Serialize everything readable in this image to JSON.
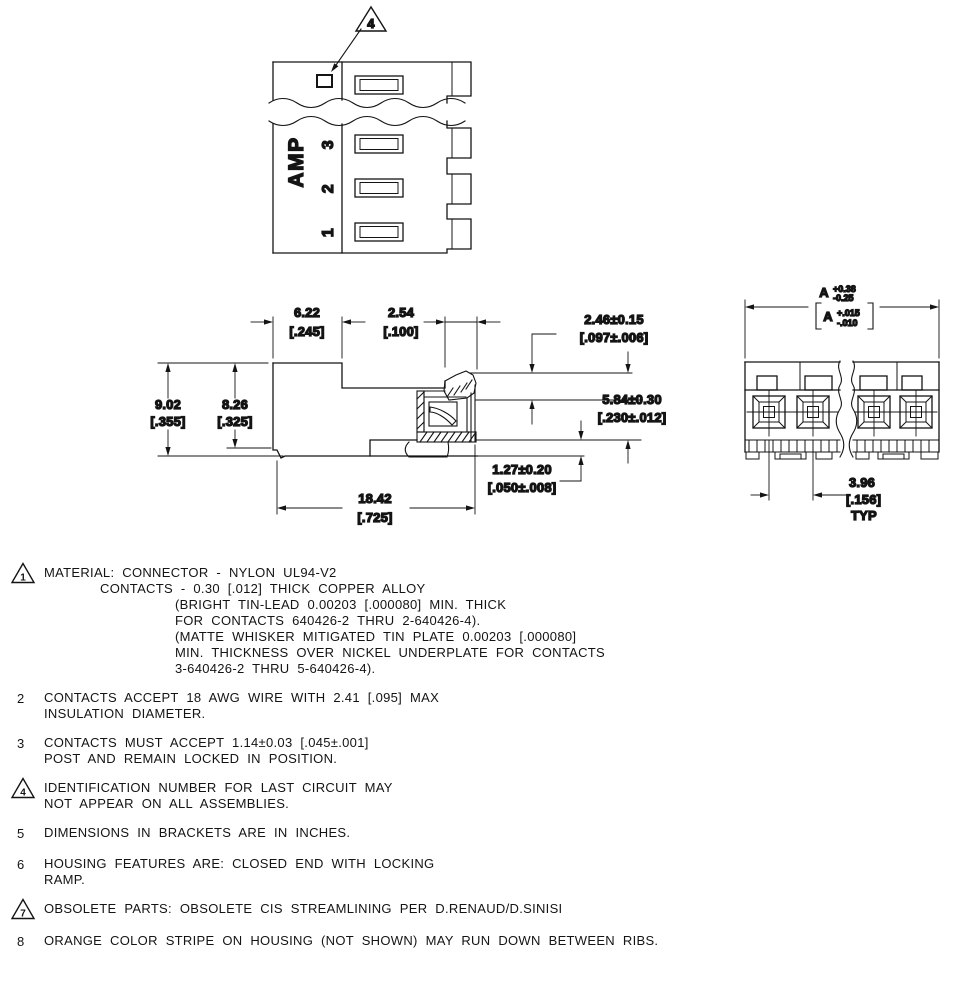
{
  "top_view": {
    "brand": "AMP",
    "circuit_3": "3",
    "circuit_2": "2",
    "circuit_1": "1",
    "callout_flag": "4"
  },
  "side_view": {
    "dim_step_mm": "6.22",
    "dim_step_in": "[.245]",
    "dim_pitch_mm": "2.54",
    "dim_pitch_in": "[.100]",
    "dim_contact_mm": "2.46±0.15",
    "dim_contact_in": "[.097±.006]",
    "dim_height_outer_mm": "9.02",
    "dim_height_outer_in": "[.355]",
    "dim_height_inner_mm": "8.26",
    "dim_height_inner_in": "[.325]",
    "dim_face_mm": "5.84±0.30",
    "dim_face_in": "[.230±.012]",
    "dim_standoff_mm": "1.27±0.20",
    "dim_standoff_in": "[.050±.008]",
    "dim_length_mm": "18.42",
    "dim_length_in": "[.725]"
  },
  "end_view": {
    "dim_a_letter": "A",
    "dim_a_plus": "+0.38",
    "dim_a_minus": "-0.25",
    "dim_a_in_letter": "A",
    "dim_a_in_plus": "+.015",
    "dim_a_in_minus": "-.010",
    "dim_pitch_mm": "3.96",
    "dim_pitch_in": "[.156]",
    "dim_pitch_typ": "TYP"
  },
  "notes": [
    {
      "num": "1",
      "lines": [
        {
          "text": "MATERIAL: CONNECTOR - NYLON UL94-V2"
        },
        {
          "text": "CONTACTS - 0.30 [.012] THICK COPPER ALLOY"
        },
        {
          "text": "(BRIGHT TIN-LEAD 0.00203 [.000080] MIN. THICK"
        },
        {
          "text": "FOR CONTACTS 640426-2 THRU 2-640426-4)."
        },
        {
          "text": "(MATTE WHISKER MITIGATED TIN PLATE 0.00203 [.000080]"
        },
        {
          "text": "MIN. THICKNESS OVER NICKEL UNDERPLATE FOR CONTACTS"
        },
        {
          "text": "3-640426-2 THRU 5-640426-4)."
        }
      ]
    },
    {
      "num": "2",
      "lines": [
        {
          "text": "CONTACTS ACCEPT 18 AWG WIRE WITH 2.41 [.095] MAX"
        },
        {
          "text": "INSULATION DIAMETER."
        }
      ]
    },
    {
      "num": "3",
      "lines": [
        {
          "text": "CONTACTS MUST ACCEPT 1.14±0.03 [.045±.001]"
        },
        {
          "text": "POST AND REMAIN LOCKED IN POSITION."
        }
      ]
    },
    {
      "num": "4",
      "lines": [
        {
          "text": "IDENTIFICATION NUMBER FOR LAST CIRCUIT MAY"
        },
        {
          "text": "NOT APPEAR ON ALL ASSEMBLIES."
        }
      ]
    },
    {
      "num": "5",
      "lines": [
        {
          "text": "DIMENSIONS IN BRACKETS ARE IN INCHES."
        }
      ]
    },
    {
      "num": "6",
      "lines": [
        {
          "text": "HOUSING FEATURES ARE: CLOSED END WITH LOCKING"
        },
        {
          "text": "RAMP."
        }
      ]
    },
    {
      "num": "7",
      "lines": [
        {
          "text": "OBSOLETE PARTS: OBSOLETE CIS STREAMLINING PER D.RENAUD/D.SINISI"
        }
      ]
    },
    {
      "num": "8",
      "lines": [
        {
          "text": "ORANGE COLOR STRIPE ON HOUSING (NOT SHOWN) MAY RUN DOWN BETWEEN RIBS."
        }
      ]
    }
  ]
}
